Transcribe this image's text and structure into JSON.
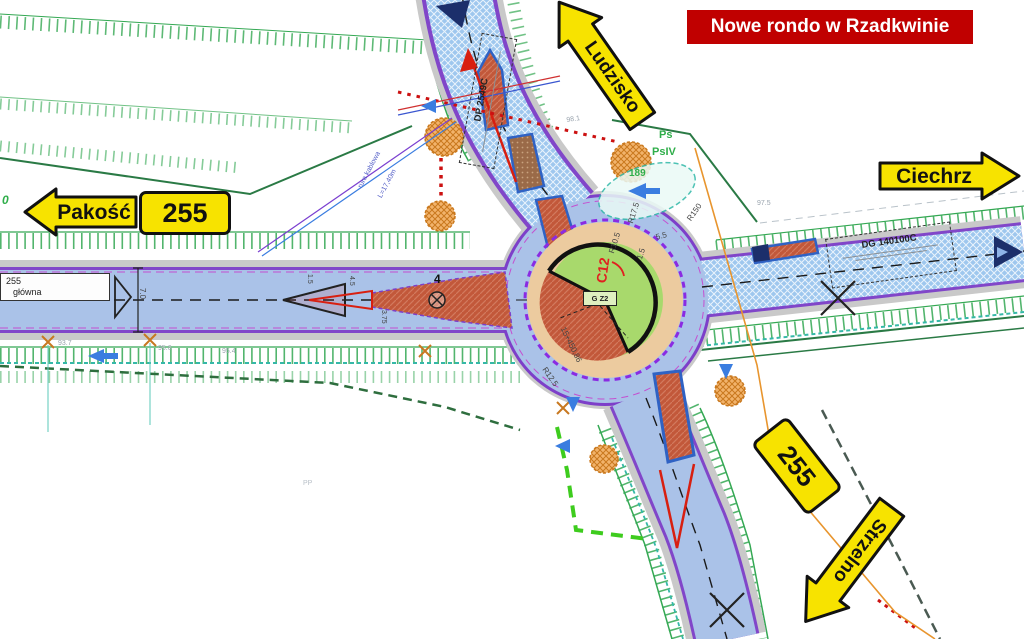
{
  "banner": {
    "text": "Nowe rondo w Rzadkwinie",
    "bg_color": "#c00000",
    "text_color": "#ffffff"
  },
  "signs": {
    "fill_color": "#f7e300",
    "border_color": "#111111",
    "ludzisko": "Ludzisko",
    "ciechrz": "Ciechrz",
    "pakosc": "Pakość",
    "strzelno": "Strzelno",
    "route_west": "255",
    "route_southeast": "255"
  },
  "plan": {
    "road_box": {
      "number": "255",
      "name": "główna"
    },
    "plates": {
      "dp_road": "DP 2549C",
      "dg_road": "DG 140100C",
      "g_z2": "G Z2",
      "c12": "C12"
    },
    "labels": {
      "station_zero": "0",
      "ch_93_7": "93.7",
      "ch_95_6": "95.6",
      "ch_95_4": "95.4",
      "ch_97_5": "97.5",
      "ch_98_1": "98.1",
      "ch_189": "189",
      "ps": "Ps",
      "psiv": "PsIV",
      "station_main": "15+450,86",
      "r17_5": "R17.5",
      "r10_5": "R10.5",
      "r150": "R150",
      "r12_5": "R12.5",
      "dim_5_5": "5.5",
      "dim_1_5": "1.5",
      "dim_1_5b": "1.5",
      "dim_4_5": "4.5",
      "dim_3_75": "3.75",
      "dim_7_0": "7.0",
      "num_4": "4",
      "pp": "PP",
      "l_17_40": "L=17,40m",
      "rura": "rura kablowa"
    },
    "colors": {
      "roadway_blue": "#aac2e8",
      "pavement_hatch_blue": "#9ec7ee",
      "shoulder_gray": "#c9c9c9",
      "island_green": "#a8d96c",
      "apron_tan": "#eccb9f",
      "splitter_terracotta": "#c2583a",
      "edge_purple": "#7d3fc9",
      "ditch_green": "#34a853",
      "utility_orange": "#e8952e",
      "crossing_red": "#cc1111",
      "navy": "#1c2f6b",
      "teal": "#2fb8a8"
    }
  }
}
